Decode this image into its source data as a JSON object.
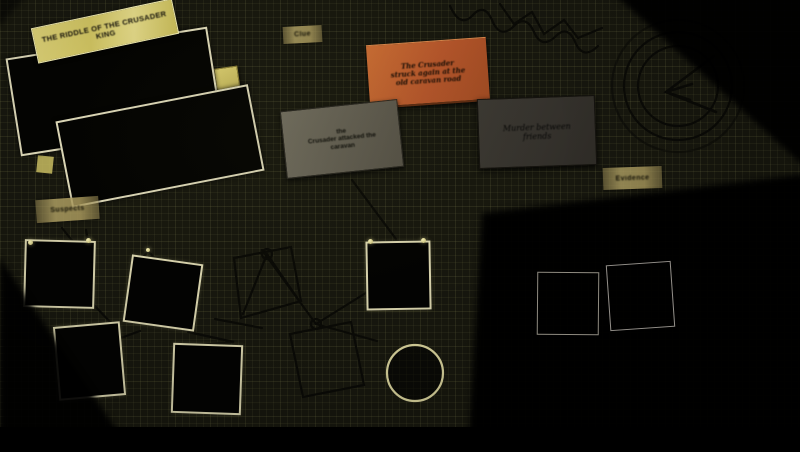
{
  "banner": {
    "line1": "THE RIDDLE OF THE CRUSADER",
    "line2": "KING"
  },
  "cards": {
    "orange": {
      "lines": [
        "The Crusader",
        "struck again at the",
        "old caravan road"
      ]
    },
    "gray": {
      "lines": [
        "the",
        "Crusader attacked the",
        "caravan"
      ]
    },
    "dark_gray": {
      "lines": [
        "Murder between",
        "friends"
      ]
    }
  },
  "tapes": {
    "clue": "Clue",
    "left": "Suspects",
    "right": "Evidence"
  },
  "photos": {
    "pinned_count": 5,
    "outline_count": 2
  },
  "annotations": {
    "circle_marker": 1,
    "drawn_target_circles": 2,
    "string_pins": 2
  },
  "colors": {
    "background": "#17170e",
    "banner_yellow": "#d2c763",
    "card_orange": "#b85a2b",
    "card_gray": "#6e6a5c",
    "card_dark_gray": "#37342e",
    "photo_border": "#d9d4b0",
    "circle_stroke": "#d6d09a",
    "tape": "#998b55",
    "string": "#0b0b06"
  }
}
